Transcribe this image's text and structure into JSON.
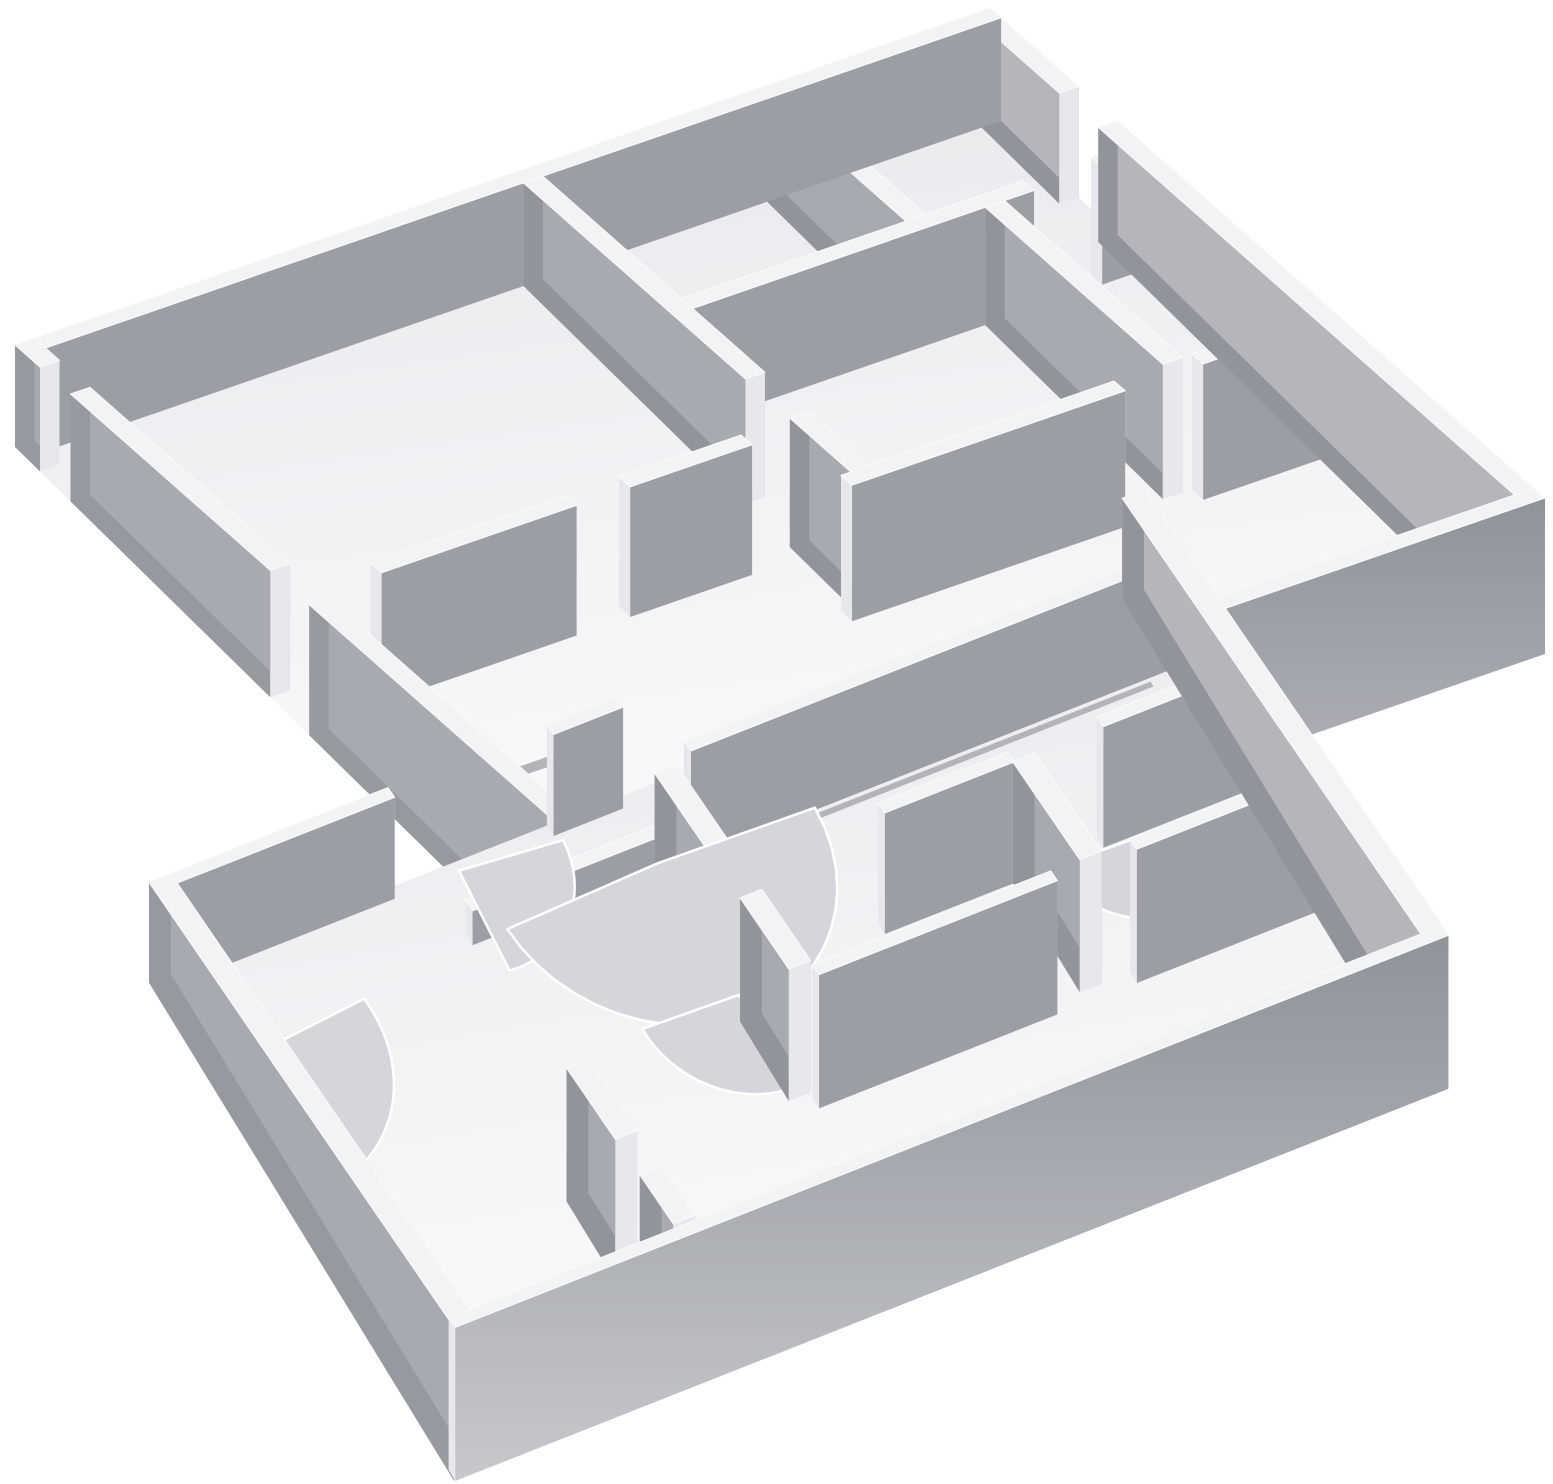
{
  "scene": {
    "description": "Monochrome 3D rendering of two extruded storey floor plans shown stacked in an exploded axonometric view; gray walls with white top rims, white room floors, doorway openings and door-swing arcs; no text or UI chrome visible",
    "canvas": {
      "width": 1553,
      "height": 1484
    },
    "background": "#ffffff",
    "palette": {
      "floor": "url(#gFloor)",
      "groove": "#b2b4ba",
      "arc": "#d5d6da",
      "arc_rim": "#ffffff",
      "south": "#9b9ea5",
      "north": "#b8bac0",
      "east": "#a8aab1",
      "west": "#92949b",
      "top": "#f2f3f5",
      "end": "#e7e8eb",
      "outer_s": "url(#gBandS)",
      "outer_e": "#b4b6bb",
      "outer_w": "#9799a0"
    },
    "trays": [
      {
        "name": "upper-storey-floor-plan",
        "origin": [
          15,
          345
        ],
        "u_axis": [
          975,
          -337
        ],
        "v_axis": [
          555,
          490
        ],
        "wall_height_px": 120,
        "wall_thickness": 0.02,
        "arc_aspect": 1.39,
        "walls": [
          {
            "name": "upper-nw-perimeter-wall",
            "axis": "u",
            "c": 0.01,
            "spans": [
              [
                0.0,
                1.0
              ]
            ],
            "faces": [
              "south",
              "top"
            ]
          },
          {
            "name": "upper-ne-perimeter-wall",
            "axis": "v",
            "c": 0.99,
            "spans": [
              [
                0.0,
                0.16
              ],
              [
                0.23,
                1.0
              ]
            ],
            "faces": [
              "west",
              "east",
              "top",
              "ends"
            ],
            "colors": {
              "east": "outer_e"
            }
          },
          {
            "name": "upper-sw-perimeter-wall",
            "axis": "v",
            "c": 0.01,
            "spans": [
              [
                0.0,
                0.045
              ],
              [
                0.1,
                0.46
              ],
              [
                0.53,
                1.0
              ]
            ],
            "faces": [
              "east",
              "west",
              "top",
              "ends"
            ],
            "colors": {
              "west": "outer_w"
            }
          },
          {
            "name": "upper-se-perimeter-wall",
            "axis": "u",
            "c": 0.99,
            "spans": [
              [
                0.0,
                1.0
              ]
            ],
            "faces": [
              "south",
              "top",
              "ends"
            ],
            "colors": {
              "south": "outer_s"
            }
          },
          {
            "name": "upper-partition-long",
            "axis": "v",
            "c": 0.52,
            "spans": [
              [
                0.02,
                0.42
              ],
              [
                0.5,
                0.63
              ]
            ],
            "faces": [
              "east",
              "west",
              "top",
              "ends"
            ]
          },
          {
            "name": "upper-partition-cross",
            "axis": "u",
            "c": 0.28,
            "spans": [
              [
                0.53,
                0.88
              ],
              [
                0.95,
                0.98
              ]
            ],
            "faces": [
              "south",
              "top",
              "ends"
            ]
          },
          {
            "name": "upper-partition-back",
            "axis": "v",
            "c": 0.77,
            "spans": [
              [
                0.02,
                0.27
              ]
            ],
            "faces": [
              "east",
              "west",
              "top",
              "ends"
            ]
          },
          {
            "name": "upper-partition-right",
            "axis": "v",
            "c": 0.84,
            "spans": [
              [
                0.29,
                0.61
              ]
            ],
            "faces": [
              "west",
              "east",
              "top",
              "ends"
            ]
          },
          {
            "name": "upper-entry-wall",
            "axis": "u",
            "c": 0.51,
            "spans": [
              [
                0.08,
                0.28
              ],
              [
                0.335,
                0.46
              ]
            ],
            "faces": [
              "south",
              "top",
              "ends"
            ]
          },
          {
            "name": "upper-front-partition",
            "axis": "u",
            "c": 0.62,
            "spans": [
              [
                0.5,
                0.78
              ],
              [
                0.86,
                0.98
              ]
            ],
            "faces": [
              "south",
              "top",
              "ends"
            ]
          }
        ],
        "grooves": [
          {
            "u": [
              0.0,
              0.17
            ],
            "v": [
              0.674,
              0.688
            ]
          },
          {
            "u": [
              0.158,
              0.172
            ],
            "v": [
              0.674,
              0.92
            ]
          }
        ],
        "arcs": []
      },
      {
        "name": "lower-storey-floor-plan",
        "origin": [
          150,
          882
        ],
        "u_axis": [
          993,
          -392
        ],
        "v_axis": [
          305,
          445
        ],
        "wall_height_px": 118,
        "wall_thickness": 0.022,
        "arc_aspect": 1.95,
        "walls": [
          {
            "name": "lower-nw-perimeter-wall",
            "axis": "u",
            "c": 0.01,
            "spans": [
              [
                0.0,
                0.24
              ],
              [
                0.4,
                0.47
              ]
            ],
            "faces": [
              "south",
              "top",
              "ends"
            ]
          },
          {
            "name": "lower-ne-perimeter-wall",
            "axis": "v",
            "c": 0.99,
            "spans": [
              [
                0.0,
                1.0
              ]
            ],
            "faces": [
              "west",
              "east",
              "top",
              "ends"
            ],
            "colors": {
              "east": "outer_e"
            }
          },
          {
            "name": "lower-sw-perimeter-wall",
            "axis": "v",
            "c": 0.01,
            "spans": [
              [
                0.0,
                1.0
              ]
            ],
            "faces": [
              "east",
              "west",
              "top",
              "ends"
            ],
            "colors": {
              "west": "outer_w"
            }
          },
          {
            "name": "lower-se-perimeter-wall",
            "axis": "u",
            "c": 0.99,
            "spans": [
              [
                0.0,
                1.0
              ]
            ],
            "faces": [
              "south",
              "top",
              "ends"
            ],
            "colors": {
              "south": "outer_s"
            }
          },
          {
            "name": "lower-central-wall",
            "axis": "u",
            "c": 0.135,
            "spans": [
              [
                0.5,
                0.98
              ]
            ],
            "faces": [
              "north",
              "south",
              "top",
              "ends"
            ]
          },
          {
            "name": "lower-central-ledge",
            "axis": "u",
            "c": 0.135,
            "h": 0.32,
            "spans": [
              [
                0.28,
                0.5
              ]
            ],
            "faces": [
              "north",
              "south",
              "top",
              "ends"
            ]
          },
          {
            "name": "lower-hall-partition",
            "axis": "v",
            "c": 0.47,
            "spans": [
              [
                0.16,
                0.34
              ],
              [
                0.44,
                0.6
              ]
            ],
            "faces": [
              "east",
              "west",
              "top",
              "ends"
            ]
          },
          {
            "name": "lower-front-partition",
            "axis": "u",
            "c": 0.62,
            "spans": [
              [
                0.48,
                0.72
              ],
              [
                0.8,
                0.98
              ]
            ],
            "faces": [
              "south",
              "top",
              "ends"
            ]
          },
          {
            "name": "lower-right-room-wall",
            "axis": "v",
            "c": 0.76,
            "spans": [
              [
                0.39,
                0.61
              ]
            ],
            "faces": [
              "west",
              "east",
              "top",
              "ends"
            ]
          },
          {
            "name": "lower-right-cross-wall",
            "axis": "u",
            "c": 0.38,
            "spans": [
              [
                0.62,
                0.75
              ],
              [
                0.84,
                0.98
              ]
            ],
            "faces": [
              "south",
              "top",
              "ends"
            ]
          },
          {
            "name": "lower-left-room-wall",
            "axis": "v",
            "c": 0.24,
            "spans": [
              [
                0.62,
                0.78
              ],
              [
                0.86,
                0.97
              ]
            ],
            "faces": [
              "east",
              "west",
              "top",
              "ends"
            ]
          }
        ],
        "grooves": [
          {
            "u": [
              0.52,
              0.96
            ],
            "v": [
              0.155,
              0.165
            ]
          }
        ],
        "arcs": [
          {
            "name": "door-swing-arc-hall",
            "c": [
              0.47,
              0.135
            ],
            "r": 0.155,
            "a0": 2,
            "a1": 178
          },
          {
            "name": "door-swing-arc-left-corner",
            "c": [
              0.03,
              0.19
            ],
            "r": 0.135,
            "a0": -5,
            "a1": 95
          },
          {
            "name": "door-swing-arc-back",
            "c": [
              0.305,
              0.02
            ],
            "r": 0.1,
            "a0": 5,
            "a1": 95
          },
          {
            "name": "door-swing-arc-mid",
            "c": [
              0.47,
              0.4
            ],
            "r": 0.095,
            "a0": 88,
            "a1": 182
          },
          {
            "name": "door-swing-arc-right",
            "c": [
              0.865,
              0.4
            ],
            "r": 0.075,
            "a0": 88,
            "a1": 182
          },
          {
            "name": "door-swing-arc-front",
            "c": [
              0.19,
              0.955
            ],
            "r": 0.085,
            "a0": 178,
            "a1": 268
          }
        ]
      }
    ]
  }
}
